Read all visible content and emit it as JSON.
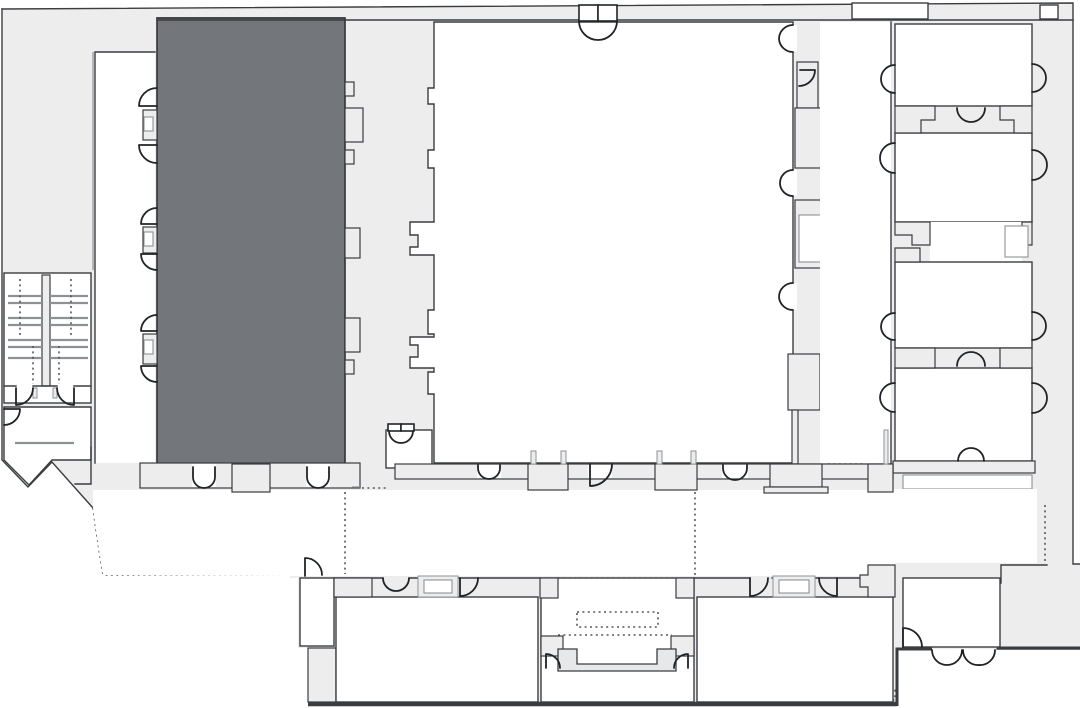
{
  "floor_plan": {
    "kind": "building-floor-plan",
    "aria_label": "Architectural floor plan with one room highlighted in dark gray",
    "background": "#ffffff",
    "colors": {
      "corridor_fill": "#ededee",
      "room_fill": "#ffffff",
      "highlight_room_fill": "#73767a",
      "highlight_room_stroke": "#303336",
      "wall_stroke": "#3a3d40",
      "door_stroke": "#212427",
      "secondary_stroke": "#8f9294",
      "dotted_stroke": "#55585b",
      "stage_fill": "#e7e8e9"
    },
    "regions": [
      {
        "id": "highlighted-room",
        "kind": "selected-room",
        "fill_key": "highlight_room_fill"
      },
      {
        "id": "main-hall",
        "kind": "room",
        "fill_key": "room_fill"
      },
      {
        "id": "west-corridor",
        "kind": "corridor",
        "fill_key": "corridor_fill"
      },
      {
        "id": "east-corridor",
        "kind": "corridor",
        "fill_key": "corridor_fill"
      },
      {
        "id": "stairwell-pair",
        "kind": "stairs",
        "fill_key": "room_fill"
      },
      {
        "id": "northeast-room-1",
        "kind": "room",
        "fill_key": "room_fill"
      },
      {
        "id": "northeast-room-2",
        "kind": "room",
        "fill_key": "room_fill"
      },
      {
        "id": "southeast-room-1",
        "kind": "room",
        "fill_key": "room_fill"
      },
      {
        "id": "southeast-room-2",
        "kind": "room",
        "fill_key": "room_fill"
      },
      {
        "id": "lobby",
        "kind": "open-area",
        "fill_key": "room_fill"
      },
      {
        "id": "south-wing-room-west",
        "kind": "room",
        "fill_key": "room_fill"
      },
      {
        "id": "south-wing-stage-room",
        "kind": "room",
        "fill_key": "room_fill"
      },
      {
        "id": "south-wing-room-east",
        "kind": "room",
        "fill_key": "room_fill"
      },
      {
        "id": "southeast-entry",
        "kind": "vestibule",
        "fill_key": "room_fill"
      }
    ],
    "symbols": {
      "door_swing": "quarter-circle arc",
      "double_door": "paired quarter-circle arcs",
      "open_passage": "dotted line",
      "stairs": "parallel tread lines with dotted run lines"
    }
  }
}
